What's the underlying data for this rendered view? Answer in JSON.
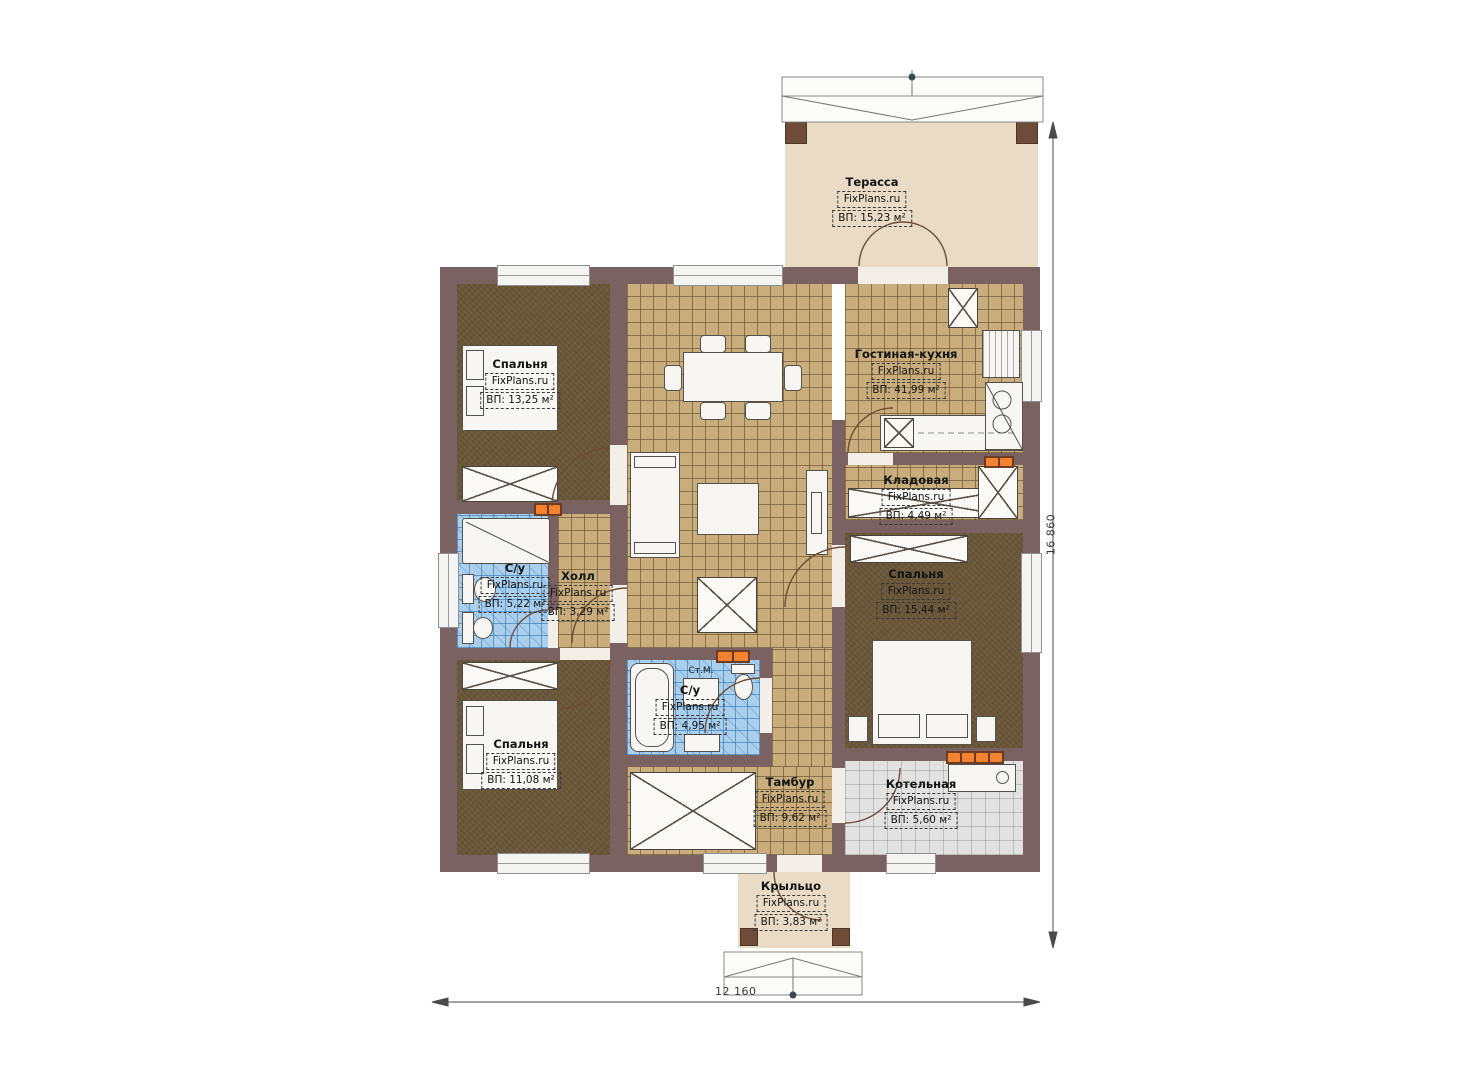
{
  "plan": {
    "brand_label": "FixPlans.ru",
    "rooms": [
      {
        "id": "terrace",
        "name": "Терасса",
        "area": "ВП: 15,23 м²"
      },
      {
        "id": "bedroom-1",
        "name": "Спальня",
        "area": "ВП: 13,25 м²"
      },
      {
        "id": "living-kitchen",
        "name": "Гостиная-кухня",
        "area": "ВП: 41,99 м²"
      },
      {
        "id": "pantry",
        "name": "Кладовая",
        "area": "ВП: 4,49 м²"
      },
      {
        "id": "bathroom-1",
        "name": "С/у",
        "area": "ВП: 5,22 м²"
      },
      {
        "id": "hall",
        "name": "Холл",
        "area": "ВП: 3,29 м²"
      },
      {
        "id": "bedroom-2",
        "name": "Спальня",
        "area": "ВП: 15,44 м²"
      },
      {
        "id": "bathroom-2",
        "name": "С/у",
        "area": "ВП: 4,95 м²"
      },
      {
        "id": "bedroom-3",
        "name": "Спальня",
        "area": "ВП: 11,08 м²"
      },
      {
        "id": "vestibule",
        "name": "Тамбур",
        "area": "ВП: 9,62 м²"
      },
      {
        "id": "boiler-room",
        "name": "Котельная",
        "area": "ВП: 5,60 м²"
      },
      {
        "id": "porch",
        "name": "Крыльцо",
        "area": "ВП: 3,83 м²"
      }
    ],
    "annotations": {
      "washing_machine": "Ст.М."
    },
    "dimensions": {
      "width": "12 160",
      "height": "16 860"
    }
  }
}
